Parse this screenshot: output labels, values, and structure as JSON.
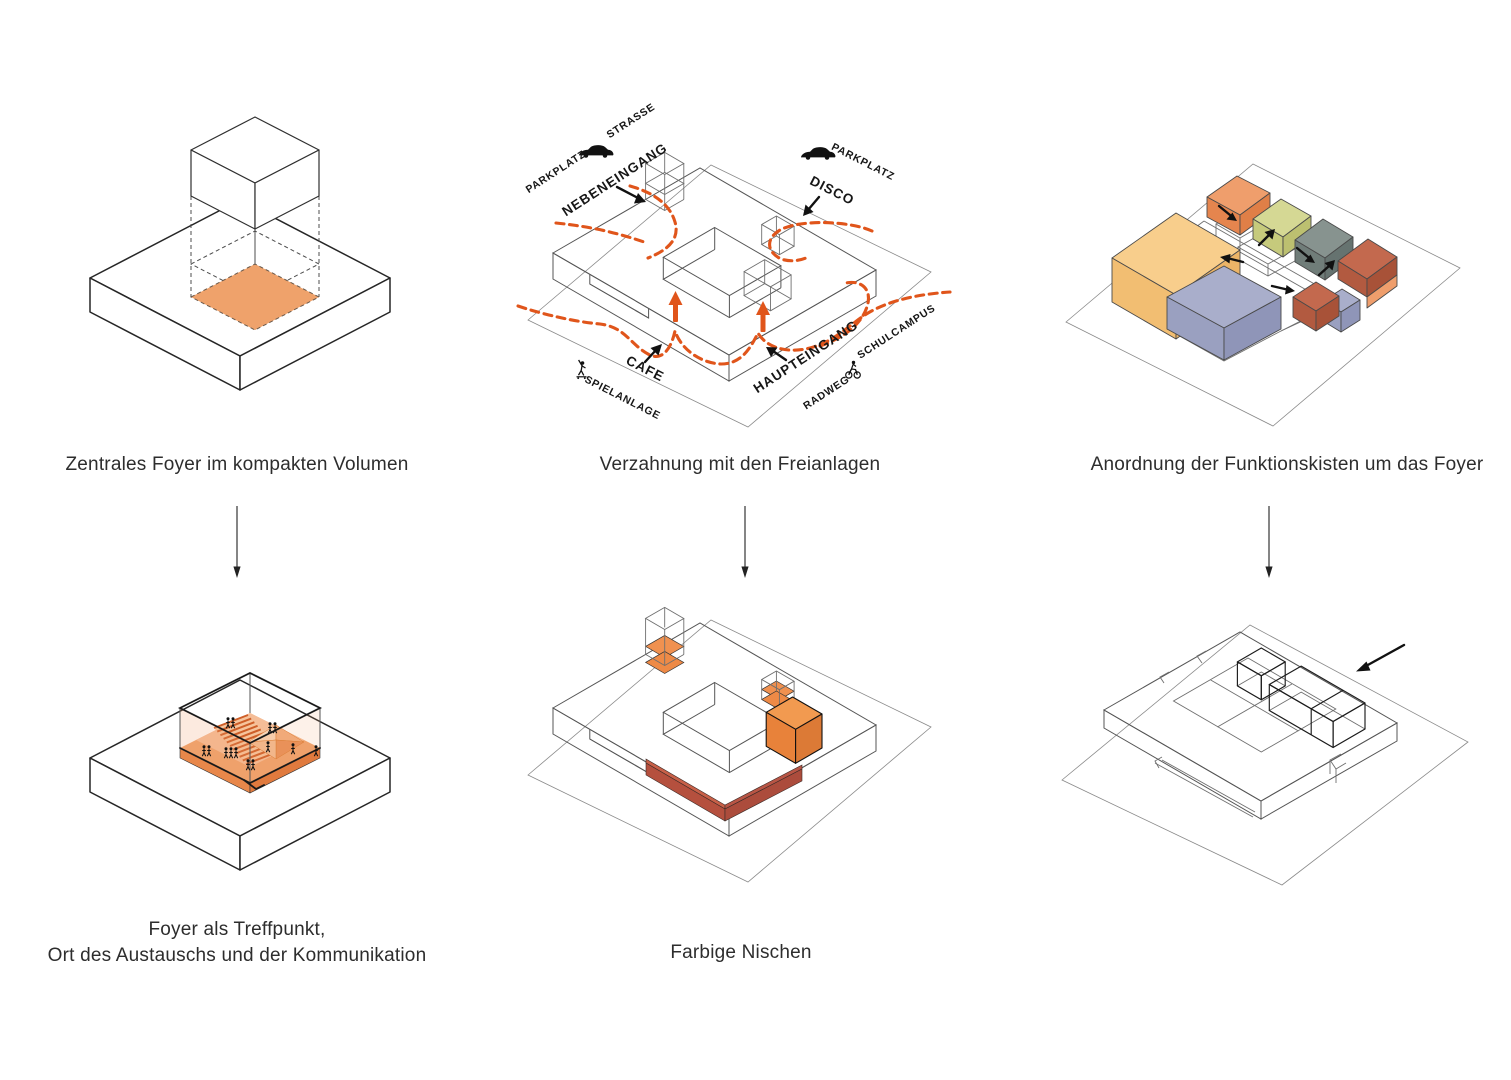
{
  "page": {
    "background": "#ffffff"
  },
  "captions": {
    "panel1": "Zentrales Foyer im kompakten Volumen",
    "panel2": "Verzahnung mit den Freianlagen",
    "panel3": "Anordnung der Funktionskisten um das Foyer",
    "panel4_line1": "Foyer als Treffpunkt,",
    "panel4_line2": "Ort des Austauschs und der Kommunikation",
    "panel5": "Farbige Nischen",
    "panel6": "Autonomie des Disco Bereichs"
  },
  "site_labels": {
    "parkplatz_left": "PARKPLATZ",
    "strasse": "STRASSE",
    "nebeneingang": "NEBENEINGANG",
    "disco": "DISCO",
    "parkplatz_right": "PARKPLATZ",
    "cafe": "CAFE",
    "spielanlage": "SPIELANLAGE",
    "haupteingang": "HAUPTEINGANG",
    "radweg": "RADWEG",
    "schulcampus": "SCHULCAMPUS"
  },
  "icons": {
    "car_left": "car-icon",
    "car_right": "car-icon",
    "skateboarder": "skateboarder-icon",
    "cyclist": "cyclist-icon",
    "flow": "arrow-down-icon"
  },
  "colors": {
    "foyer_orange": "#EFA26B",
    "foyer_floor_light": "#F5BD97",
    "foyer_edge": "#E8874A",
    "path_orange": "#E0551B",
    "box_orange_top": "#EF9E6C",
    "olive_top": "#D5D894",
    "gray_top": "#87938F",
    "terracotta_top": "#C3694E",
    "sand_top": "#F8CE8C",
    "lavender_top": "#A9AECB",
    "band_front": "#B5503E",
    "band_top": "#C86048",
    "niche_orange": "#F09150",
    "box5_top": "#F29A50",
    "d6_box_top": "rgba(242,156,88,0.85)"
  }
}
